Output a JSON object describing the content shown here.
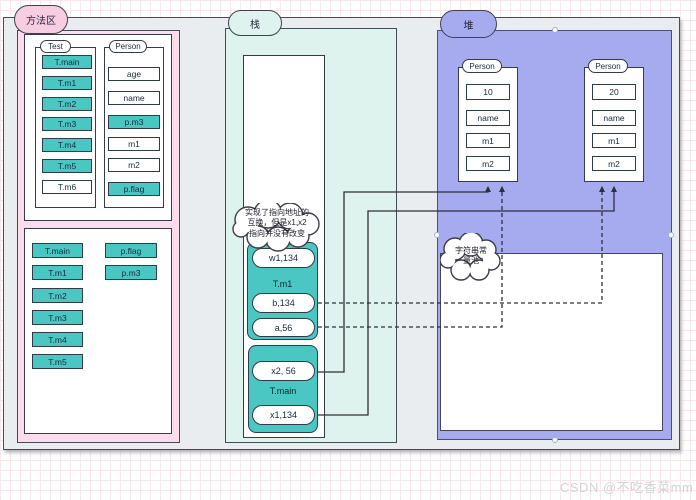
{
  "labels": {
    "method_area": "方法区",
    "stack": "栈",
    "heap": "堆"
  },
  "method_area": {
    "class_box": {
      "groups": [
        {
          "label": "Test",
          "items": [
            {
              "text": "T.main",
              "filled": true
            },
            {
              "text": "T.m1",
              "filled": true
            },
            {
              "text": "T.m2",
              "filled": true
            },
            {
              "text": "T.m3",
              "filled": true
            },
            {
              "text": "T.m4",
              "filled": true
            },
            {
              "text": "T.m5",
              "filled": true
            },
            {
              "text": "T.m6",
              "filled": false
            }
          ]
        },
        {
          "label": "Person",
          "items": [
            {
              "text": "age",
              "filled": false
            },
            {
              "text": "name",
              "filled": false
            },
            {
              "text": "p.m3",
              "filled": true
            },
            {
              "text": "m1",
              "filled": false
            },
            {
              "text": "m2",
              "filled": false
            },
            {
              "text": "p.flag",
              "filled": true
            }
          ]
        }
      ]
    },
    "loaded_box": {
      "left_items": [
        "T.main",
        "T.m1",
        "T.m2",
        "T.m3",
        "T.m4",
        "T.m5"
      ],
      "right_items": [
        "p.flag",
        "p.m3"
      ]
    }
  },
  "stack": {
    "note": "实现了指向地址的\n互换，但是x1,x2\n指向并没有改变",
    "frames": [
      {
        "name": "T.m1",
        "slot_above": "w1,134",
        "slots_below": [
          "b,134",
          "a,56"
        ]
      },
      {
        "name": "T.main",
        "slot_above": "x2, 56",
        "slots_below": [
          "x1,134"
        ]
      }
    ]
  },
  "heap": {
    "string_pool_label": "字符串常\n量池",
    "objects": [
      {
        "label": "Person",
        "fields": [
          "10",
          "name",
          "m1",
          "m2"
        ]
      },
      {
        "label": "Person",
        "fields": [
          "20",
          "name",
          "m1",
          "m2"
        ]
      }
    ]
  },
  "watermark": "CSDN @不吃香菜mm",
  "colors": {
    "teal": "#4bc7c3",
    "pink_region": "#fbdcec",
    "mint_region": "#dff3ee",
    "heap_region": "#a6abf0",
    "canvas_gray": "#e9edf0"
  }
}
